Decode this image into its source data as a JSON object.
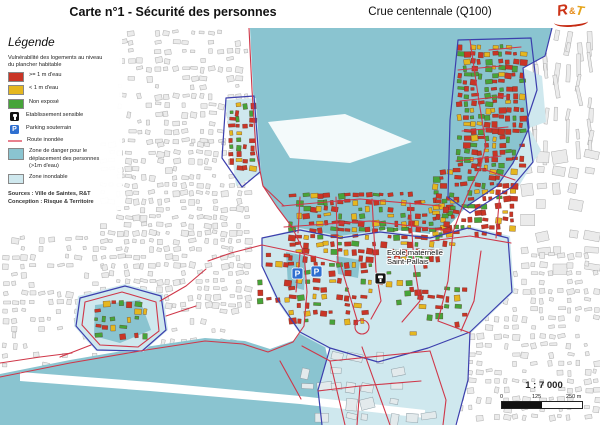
{
  "header": {
    "title": "Carte n°1 - Sécurité des personnes",
    "subtitle": "Crue centennale (Q100)",
    "logo_text_1": "R",
    "logo_text_2": "&",
    "logo_text_3": "T"
  },
  "legend": {
    "title": "Légende",
    "intro": "Vulnérabilité des logements au niveau du plancher habitable",
    "items": [
      {
        "type": "swatch",
        "color": "#c93526",
        "label": ">= 1 m d'eau"
      },
      {
        "type": "swatch",
        "color": "#e5b71f",
        "label": "< 1 m d'eau"
      },
      {
        "type": "swatch",
        "color": "#46a439",
        "label": "Non exposé"
      },
      {
        "type": "icon",
        "icon": "sensitive-facility-icon",
        "label": "Etablissement sensible"
      },
      {
        "type": "icon",
        "icon": "underground-parking-icon",
        "label": "Parking souterrain"
      },
      {
        "type": "line",
        "color": "#e8808e",
        "label": "Route inondée"
      },
      {
        "type": "swatch_tall",
        "color": "#8ac4d0",
        "label": "Zone de danger pour le déplacement des personnes (>1m d'eau)"
      },
      {
        "type": "swatch",
        "color": "#cfe8ee",
        "label": "Zone inondable"
      }
    ],
    "sources": "Sources : Ville de Saintes, R&T",
    "conception": "Conception : Risque & Territoire"
  },
  "map": {
    "colors": {
      "water_danger": "#8ac4d0",
      "flood_light": "#cfe8ee",
      "building_red": "#c93526",
      "building_yellow": "#e5b71f",
      "building_green": "#46a439",
      "route_red": "#cf3749",
      "zone_outline": "#3c3fad",
      "gray_building_fill": "#ebebeb",
      "gray_building_stroke": "#a9a9a9",
      "parking_blue": "#2f6fd0",
      "facility_black": "#141414"
    },
    "markers": {
      "parkings": [
        {
          "x": 292,
          "y": 268
        },
        {
          "x": 311,
          "y": 266
        }
      ],
      "school": {
        "x": 375,
        "y": 273,
        "label_line1": "Ecole maternelle",
        "label_line2": "Saint-Pallais",
        "label_x": 387,
        "label_y": 255
      }
    },
    "scale": {
      "ratio": "1 : 7 000",
      "tick0": "0",
      "tick1": "125",
      "tick2": "250 m"
    }
  }
}
